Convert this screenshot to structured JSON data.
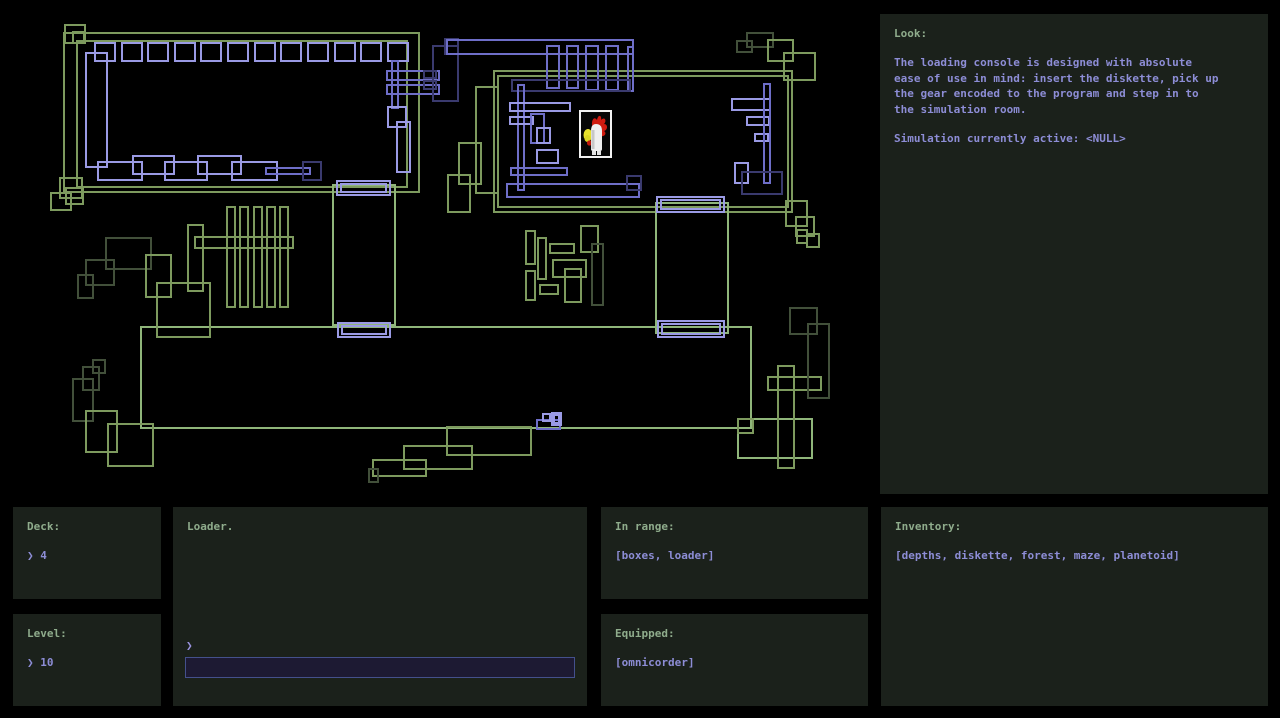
{
  "colors": {
    "background": "#000000",
    "panel_bg": "#1b211b",
    "label_green": "#8fac8c",
    "text_periwinkle": "#8d8dd6",
    "input_bg": "#1d1a33",
    "input_border": "#44508c"
  },
  "panels": {
    "look": {
      "title": "Look:",
      "body_lines": [
        "The loading console is designed with absolute",
        "ease of use in mind: insert the diskette, pick up",
        "the gear encoded to the program and step in to",
        "the simulation room."
      ],
      "status": "Simulation currently active: <NULL>"
    },
    "deck": {
      "title": "Deck:",
      "value": "❯ 4"
    },
    "level": {
      "title": "Level:",
      "value": "❯ 10"
    },
    "loader": {
      "title": "Loader.",
      "prompt": "❯",
      "input_value": "",
      "input_placeholder": ""
    },
    "in_range": {
      "title": "In range:",
      "value": "[boxes, loader]"
    },
    "equipped": {
      "title": "Equipped:",
      "value": "[omnicorder]"
    },
    "inventory": {
      "title": "Inventory:",
      "value": "[depths, diskette, forest, maze, planetoid]"
    }
  },
  "map": {
    "player": {
      "label": "chicken-avatar",
      "x": 579,
      "y": 110,
      "w": 33,
      "h": 48
    },
    "palette": {
      "g1": "#8fb57a",
      "g2": "#7d9a5e",
      "g3": "#42503a",
      "b1": "#9a9ae4",
      "b2": "#6e6ec8",
      "b3": "#3a3a6e",
      "frame": "#f2f2f2",
      "comb": "#cf1b10",
      "beak": "#e6e12c",
      "body": "#efefef"
    },
    "rects": [
      [
        64,
        33,
        355,
        159,
        "g2"
      ],
      [
        77,
        41,
        330,
        146,
        "g2"
      ],
      [
        65,
        25,
        20,
        18,
        "g2"
      ],
      [
        73,
        32,
        11,
        11,
        "g2"
      ],
      [
        494,
        71,
        298,
        141,
        "g2"
      ],
      [
        498,
        76,
        290,
        131,
        "g2"
      ],
      [
        141,
        327,
        610,
        101,
        "g1"
      ],
      [
        333,
        185,
        62,
        140,
        "g1"
      ],
      [
        656,
        203,
        72,
        130,
        "g1"
      ],
      [
        227,
        207,
        8,
        100,
        "g2"
      ],
      [
        240,
        207,
        8,
        100,
        "g2"
      ],
      [
        254,
        207,
        8,
        100,
        "g2"
      ],
      [
        267,
        207,
        8,
        100,
        "g2"
      ],
      [
        280,
        207,
        8,
        100,
        "g2"
      ],
      [
        195,
        237,
        98,
        11,
        "g2"
      ],
      [
        188,
        225,
        15,
        66,
        "g2"
      ],
      [
        106,
        238,
        45,
        31,
        "g3"
      ],
      [
        86,
        260,
        28,
        25,
        "g3"
      ],
      [
        78,
        275,
        15,
        23,
        "g3"
      ],
      [
        146,
        255,
        25,
        42,
        "g2"
      ],
      [
        157,
        283,
        53,
        54,
        "g2"
      ],
      [
        60,
        178,
        22,
        20,
        "g2"
      ],
      [
        51,
        193,
        20,
        17,
        "g2"
      ],
      [
        66,
        188,
        17,
        16,
        "g2"
      ],
      [
        476,
        87,
        22,
        106,
        "g2"
      ],
      [
        459,
        143,
        22,
        41,
        "g2"
      ],
      [
        448,
        175,
        22,
        37,
        "g2"
      ],
      [
        747,
        33,
        26,
        14,
        "g3"
      ],
      [
        737,
        41,
        15,
        11,
        "g3"
      ],
      [
        768,
        40,
        25,
        21,
        "g2"
      ],
      [
        784,
        53,
        31,
        27,
        "g2"
      ],
      [
        786,
        201,
        21,
        25,
        "g2"
      ],
      [
        796,
        217,
        18,
        19,
        "g2"
      ],
      [
        797,
        230,
        10,
        13,
        "g2"
      ],
      [
        807,
        234,
        12,
        13,
        "g2"
      ],
      [
        93,
        360,
        12,
        13,
        "g3"
      ],
      [
        83,
        367,
        16,
        23,
        "g3"
      ],
      [
        73,
        379,
        20,
        42,
        "g3"
      ],
      [
        86,
        411,
        31,
        41,
        "g2"
      ],
      [
        108,
        424,
        45,
        42,
        "g2"
      ],
      [
        447,
        427,
        84,
        28,
        "g2"
      ],
      [
        404,
        446,
        68,
        23,
        "g2"
      ],
      [
        373,
        460,
        53,
        16,
        "g2"
      ],
      [
        369,
        469,
        9,
        13,
        "g3"
      ],
      [
        738,
        419,
        74,
        39,
        "g1"
      ],
      [
        778,
        366,
        16,
        102,
        "g2"
      ],
      [
        768,
        377,
        53,
        13,
        "g2"
      ],
      [
        738,
        419,
        15,
        14,
        "g2"
      ],
      [
        790,
        308,
        27,
        26,
        "g3"
      ],
      [
        808,
        324,
        21,
        74,
        "g3"
      ],
      [
        526,
        231,
        9,
        33,
        "g2"
      ],
      [
        538,
        238,
        8,
        41,
        "g2"
      ],
      [
        550,
        244,
        24,
        9,
        "g2"
      ],
      [
        581,
        226,
        17,
        26,
        "g2"
      ],
      [
        592,
        244,
        11,
        61,
        "g3"
      ],
      [
        553,
        260,
        33,
        17,
        "g2"
      ],
      [
        565,
        269,
        16,
        33,
        "g2"
      ],
      [
        526,
        271,
        9,
        29,
        "g2"
      ],
      [
        540,
        285,
        18,
        9,
        "g2"
      ],
      [
        95,
        43,
        20,
        18,
        "b1"
      ],
      [
        122,
        43,
        20,
        18,
        "b1"
      ],
      [
        148,
        43,
        20,
        18,
        "b1"
      ],
      [
        175,
        43,
        20,
        18,
        "b1"
      ],
      [
        201,
        43,
        20,
        18,
        "b1"
      ],
      [
        228,
        43,
        20,
        18,
        "b1"
      ],
      [
        255,
        43,
        20,
        18,
        "b1"
      ],
      [
        281,
        43,
        20,
        18,
        "b1"
      ],
      [
        308,
        43,
        20,
        18,
        "b1"
      ],
      [
        335,
        43,
        20,
        18,
        "b1"
      ],
      [
        361,
        43,
        20,
        18,
        "b1"
      ],
      [
        388,
        43,
        20,
        18,
        "b1"
      ],
      [
        86,
        53,
        21,
        114,
        "b1"
      ],
      [
        98,
        162,
        44,
        18,
        "b1"
      ],
      [
        133,
        156,
        41,
        18,
        "b1"
      ],
      [
        165,
        162,
        42,
        18,
        "b1"
      ],
      [
        198,
        156,
        43,
        18,
        "b1"
      ],
      [
        232,
        162,
        45,
        18,
        "b1"
      ],
      [
        266,
        168,
        44,
        6,
        "b2"
      ],
      [
        303,
        162,
        18,
        18,
        "b3"
      ],
      [
        387,
        71,
        52,
        9,
        "b2"
      ],
      [
        387,
        85,
        52,
        9,
        "b2"
      ],
      [
        392,
        61,
        6,
        47,
        "b2"
      ],
      [
        388,
        107,
        18,
        20,
        "b1"
      ],
      [
        397,
        122,
        13,
        50,
        "b1"
      ],
      [
        433,
        46,
        25,
        55,
        "b3"
      ],
      [
        445,
        39,
        13,
        15,
        "b3"
      ],
      [
        424,
        71,
        12,
        7,
        "b3"
      ],
      [
        424,
        81,
        12,
        8,
        "b3"
      ],
      [
        447,
        40,
        186,
        14,
        "b2"
      ],
      [
        547,
        46,
        12,
        42,
        "b2"
      ],
      [
        567,
        46,
        11,
        42,
        "b2"
      ],
      [
        586,
        46,
        12,
        44,
        "b2"
      ],
      [
        606,
        46,
        12,
        44,
        "b2"
      ],
      [
        628,
        47,
        5,
        44,
        "b2"
      ],
      [
        512,
        80,
        118,
        11,
        "b3"
      ],
      [
        518,
        85,
        6,
        105,
        "b2"
      ],
      [
        510,
        103,
        60,
        8,
        "b1"
      ],
      [
        510,
        117,
        23,
        7,
        "b1"
      ],
      [
        531,
        114,
        13,
        29,
        "b2"
      ],
      [
        537,
        128,
        13,
        15,
        "b1"
      ],
      [
        537,
        150,
        21,
        13,
        "b1"
      ],
      [
        511,
        168,
        56,
        7,
        "b2"
      ],
      [
        507,
        184,
        132,
        13,
        "b2"
      ],
      [
        627,
        176,
        14,
        14,
        "b3"
      ],
      [
        732,
        99,
        38,
        11,
        "b1"
      ],
      [
        747,
        117,
        22,
        8,
        "b1"
      ],
      [
        755,
        134,
        13,
        7,
        "b1"
      ],
      [
        764,
        84,
        6,
        99,
        "b2"
      ],
      [
        735,
        163,
        13,
        20,
        "b1"
      ],
      [
        742,
        172,
        40,
        22,
        "b3"
      ],
      [
        337,
        181,
        53,
        14,
        "b1"
      ],
      [
        341,
        184,
        45,
        8,
        "b1"
      ],
      [
        338,
        323,
        52,
        14,
        "b1"
      ],
      [
        342,
        326,
        44,
        8,
        "b1"
      ],
      [
        657,
        197,
        67,
        15,
        "b1"
      ],
      [
        661,
        200,
        59,
        9,
        "b1"
      ],
      [
        658,
        321,
        66,
        16,
        "b1"
      ],
      [
        662,
        324,
        58,
        10,
        "b1"
      ],
      [
        537,
        420,
        23,
        9,
        "b2"
      ],
      [
        543,
        414,
        7,
        7,
        "b1"
      ],
      [
        552,
        413,
        9,
        12,
        "b1"
      ],
      [
        554,
        415,
        5,
        8,
        "b1"
      ]
    ]
  }
}
